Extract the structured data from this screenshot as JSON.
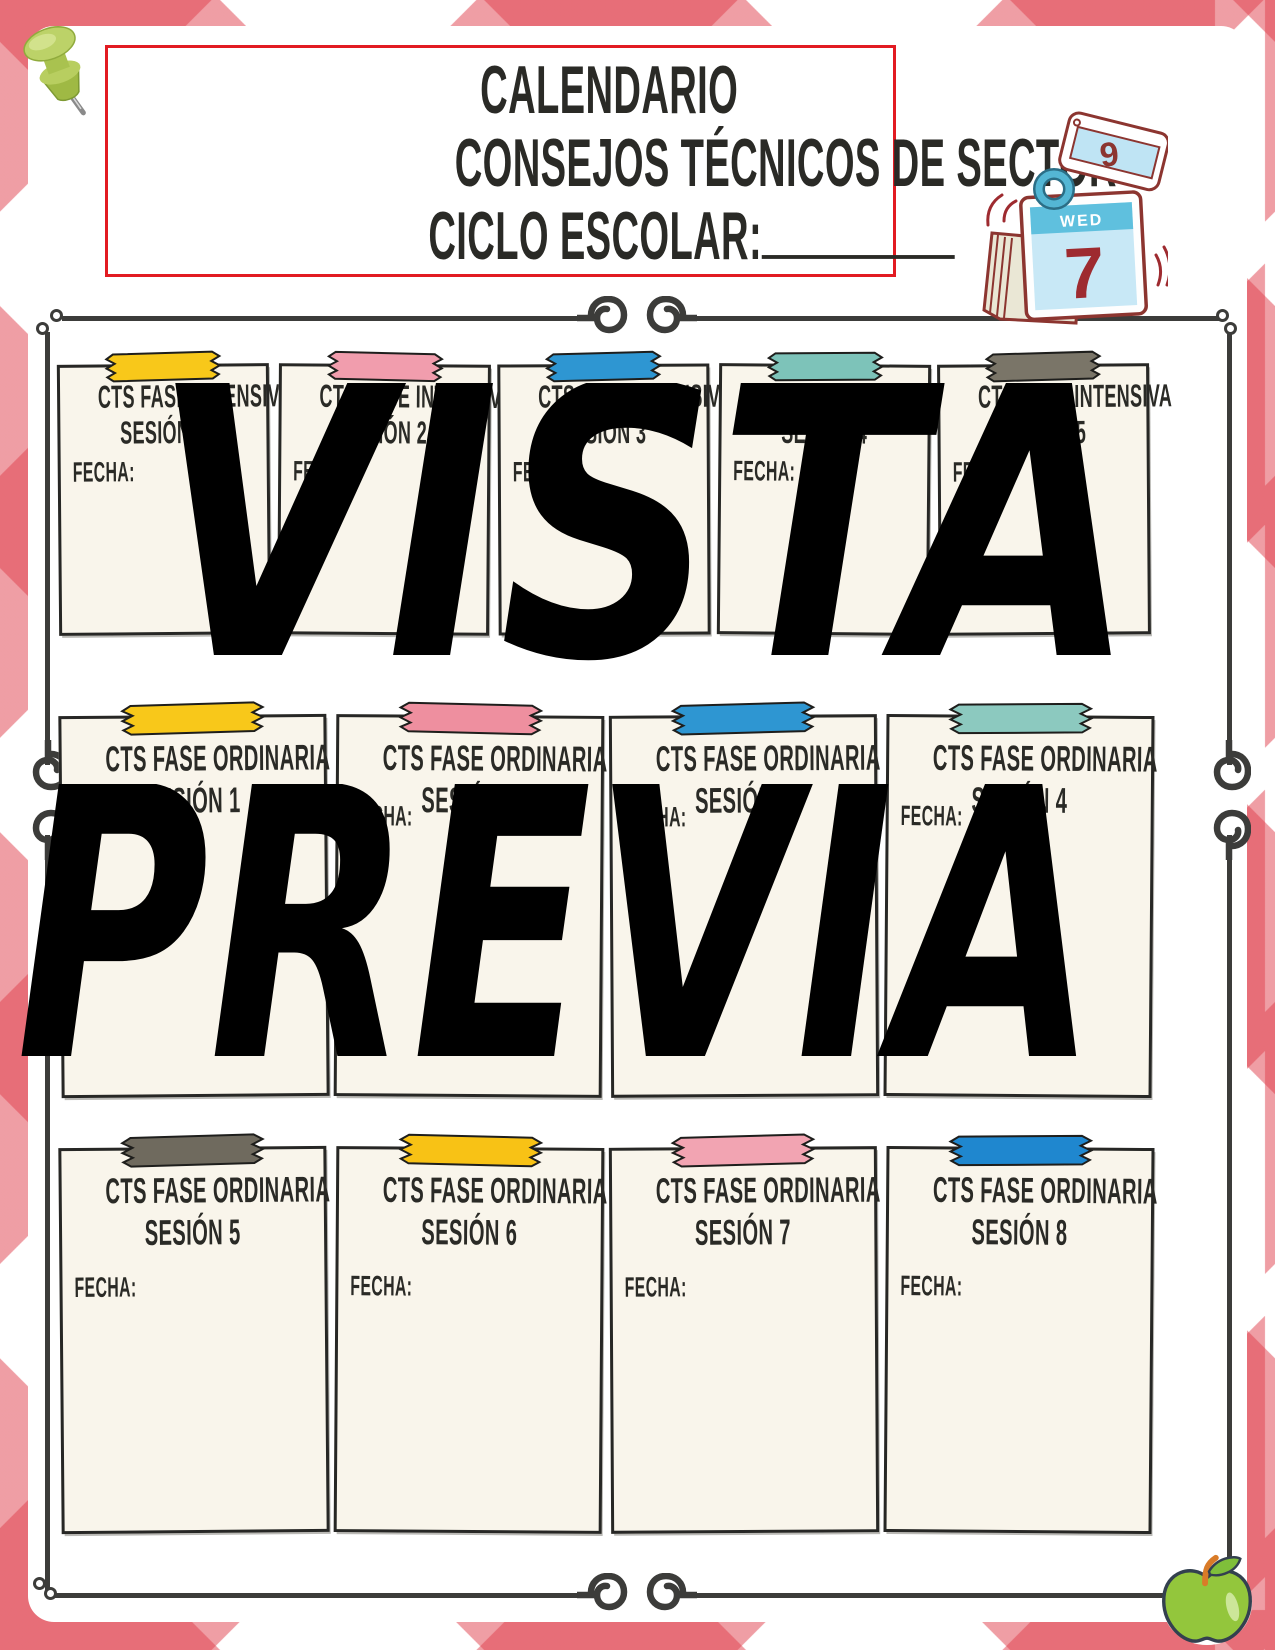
{
  "header": {
    "title_line1": "CALENDARIO",
    "title_line2": "CONSEJOS TÉCNICOS DE SECTOR",
    "title_line3": "CICLO ESCOLAR:"
  },
  "watermark": {
    "line1": "VISTA",
    "line2": "PREVIA"
  },
  "calendar_sticker": {
    "day_label": "WED",
    "day_number": "7",
    "flip_number": "6"
  },
  "colors": {
    "gingham_red": "#DF3E4B",
    "header_border": "#E21B22",
    "frame": "#3C3C3A",
    "card_bg": "#F9F5EB",
    "ink": "#2A2A26",
    "watermark": "#000000"
  },
  "cards": [
    {
      "line1": "CTS FASE INTENSIVA",
      "line2": "SESIÓN 1",
      "fecha": "FECHA:",
      "tape": "#F8C81A"
    },
    {
      "line1": "CTS FASE INTENSIVA",
      "line2": "SESIÓN 2",
      "fecha": "FECHA:",
      "tape": "#F19DAD"
    },
    {
      "line1": "CTS FASE INTENSIVA",
      "line2": "SESIÓN 3",
      "fecha": "FECHA:",
      "tape": "#2E96D2"
    },
    {
      "line1": "CTS FASE INTENSIVA",
      "line2": "SESIÓN 4",
      "fecha": "FECHA:",
      "tape": "#7DC3B9"
    },
    {
      "line1": "CTS FASE INTENSIVA",
      "line2": "SESIÓN 5",
      "fecha": "FECHA:",
      "tape": "#7A7568"
    },
    {
      "line1": "CTS FASE ORDINARIA",
      "line2": "SESIÓN 1",
      "fecha": "FECHA:",
      "tape": "#F8C81A"
    },
    {
      "line1": "CTS FASE ORDINARIA",
      "line2": "SESIÓN 2",
      "fecha": "FECHA:",
      "tape": "#EE8F9F"
    },
    {
      "line1": "CTS FASE ORDINARIA",
      "line2": "SESIÓN 3",
      "fecha": "FECHA:",
      "tape": "#2E96D2"
    },
    {
      "line1": "CTS FASE ORDINARIA",
      "line2": "SESIÓN 4",
      "fecha": "FECHA:",
      "tape": "#8CC9BF"
    },
    {
      "line1": "CTS FASE ORDINARIA",
      "line2": "SESIÓN 5",
      "fecha": "FECHA:",
      "tape": "#6F6A5E"
    },
    {
      "line1": "CTS FASE ORDINARIA",
      "line2": "SESIÓN 6",
      "fecha": "FECHA:",
      "tape": "#F8C215"
    },
    {
      "line1": "CTS FASE ORDINARIA",
      "line2": "SESIÓN 7",
      "fecha": "FECHA:",
      "tape": "#F2A4B2"
    },
    {
      "line1": "CTS FASE ORDINARIA",
      "line2": "SESIÓN 8",
      "fecha": "FECHA:",
      "tape": "#1F87CF"
    }
  ]
}
